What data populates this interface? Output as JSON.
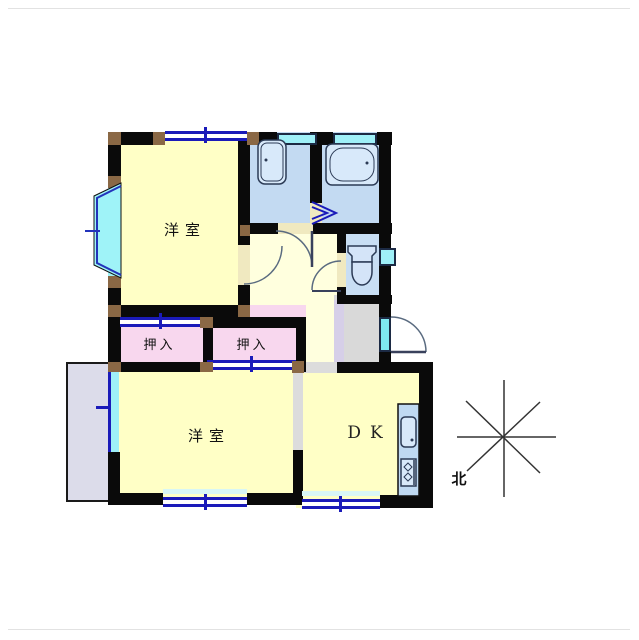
{
  "floor_plan": {
    "rooms": {
      "western_room_1": {
        "label": "洋室"
      },
      "western_room_2": {
        "label": "洋室"
      },
      "dining_kitchen": {
        "label": "DK"
      },
      "closet_left": {
        "label": "押入"
      },
      "closet_right": {
        "label": "押入"
      }
    },
    "compass": {
      "north_label": "北"
    },
    "colors": {
      "wall": "#0a0a0a",
      "room_yellow": "#FFFFC6",
      "hall_yellow": "#FFFFDE",
      "wet_area_blue": "#C3DAF2",
      "closet_pink": "#F8D7EE",
      "entry_gray": "#D9D9D9",
      "window_cyan": "#9FF0F8",
      "window_navy": "#1A1AB9",
      "corner_post_brown": "#8A6845",
      "door_gap_tan": "#F0E9C0",
      "balcony_lavender": "#DCDCEA"
    },
    "fixtures": [
      "washbasin",
      "bathtub",
      "toilet",
      "kitchen-sink",
      "stove",
      "bay-window",
      "entrance-door",
      "folding-door"
    ]
  }
}
